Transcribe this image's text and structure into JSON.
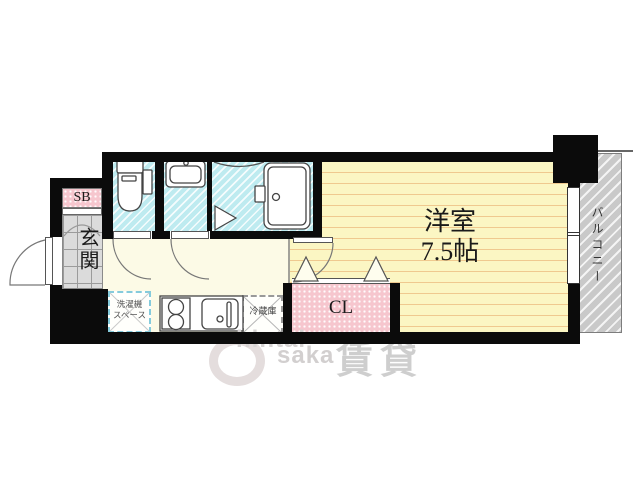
{
  "floor_plan": {
    "main_room": {
      "name": "洋室",
      "size": "7.5帖"
    },
    "closet_label": "CL",
    "shoe_box_label": "SB",
    "entrance_label": "玄関",
    "balcony_label": "バルコニー",
    "refrigerator_label": "冷蔵庫",
    "washer_space_line1": "洗濯機",
    "washer_space_line2": "スペース"
  },
  "watermark": {
    "text_top": "hintai",
    "text_bottom": "saka",
    "kanji": "賃貸"
  },
  "colors": {
    "wall": "#0b0b0b",
    "room_floor": "#FBF6C3",
    "room_floor_line": "#EFC98F",
    "hall_floor": "#FCFAE6",
    "wet_area_floor": "#BEEBF0",
    "entrance_tile": "#DBDBDB",
    "closet_pink": "#F6C6CE",
    "balcony_gray": "#C9C9C9",
    "washer_dash_border": "#85CBDC"
  }
}
